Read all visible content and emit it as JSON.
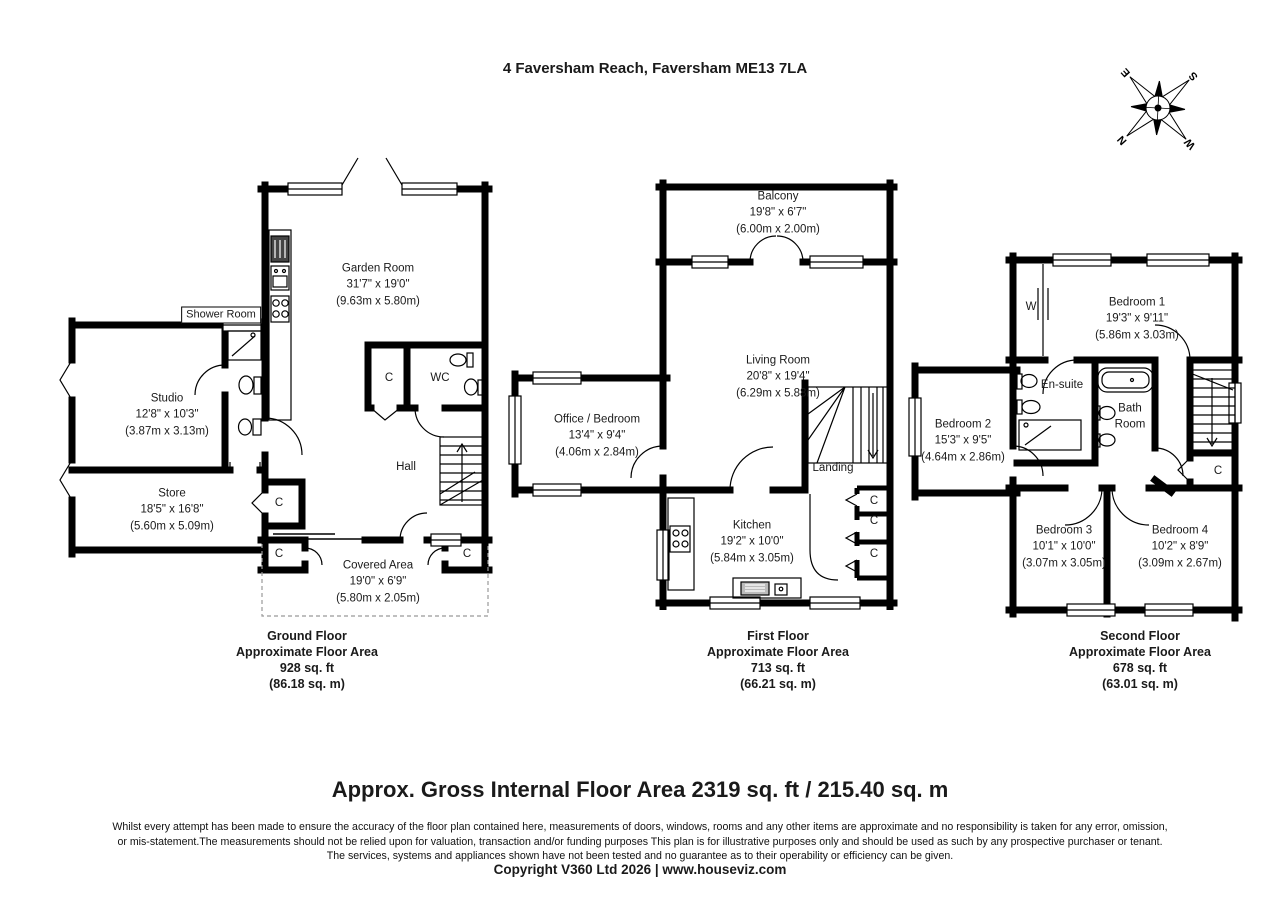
{
  "header": {
    "title": "4 Faversham Reach, Faversham ME13 7LA"
  },
  "compass": {
    "n": "N",
    "e": "E",
    "s": "S",
    "w": "W"
  },
  "labels": {
    "closet": "C",
    "wardrobe": "W"
  },
  "floors": {
    "ground": {
      "caption": {
        "name": "Ground Floor",
        "area_label": "Approximate Floor Area",
        "area_ft": "928 sq. ft",
        "area_m": "(86.18 sq. m)"
      },
      "rooms": {
        "garden_room": {
          "name": "Garden Room",
          "ft": "31'7\" x 19'0\"",
          "m": "(9.63m x 5.80m)"
        },
        "shower_room": {
          "name": "Shower Room"
        },
        "studio": {
          "name": "Studio",
          "ft": "12'8\" x 10'3\"",
          "m": "(3.87m x 3.13m)"
        },
        "store": {
          "name": "Store",
          "ft": "18'5\" x 16'8\"",
          "m": "(5.60m x 5.09m)"
        },
        "hall": {
          "name": "Hall"
        },
        "wc": {
          "name": "WC"
        },
        "covered_area": {
          "name": "Covered Area",
          "ft": "19'0\" x 6'9\"",
          "m": "(5.80m x 2.05m)"
        }
      }
    },
    "first": {
      "caption": {
        "name": "First Floor",
        "area_label": "Approximate Floor Area",
        "area_ft": "713 sq. ft",
        "area_m": "(66.21 sq. m)"
      },
      "rooms": {
        "balcony": {
          "name": "Balcony",
          "ft": "19'8\" x 6'7\"",
          "m": "(6.00m x 2.00m)"
        },
        "living_room": {
          "name": "Living Room",
          "ft": "20'8\" x 19'4\"",
          "m": "(6.29m x 5.88m)"
        },
        "office_bedroom": {
          "name": "Office / Bedroom",
          "ft": "13'4\" x 9'4\"",
          "m": "(4.06m x 2.84m)"
        },
        "landing": {
          "name": "Landing"
        },
        "kitchen": {
          "name": "Kitchen",
          "ft": "19'2\" x 10'0\"",
          "m": "(5.84m x 3.05m)"
        }
      }
    },
    "second": {
      "caption": {
        "name": "Second Floor",
        "area_label": "Approximate Floor Area",
        "area_ft": "678 sq. ft",
        "area_m": "(63.01 sq. m)"
      },
      "rooms": {
        "bedroom1": {
          "name": "Bedroom 1",
          "ft": "19'3\" x 9'11\"",
          "m": "(5.86m x 3.03m)"
        },
        "bedroom2": {
          "name": "Bedroom 2",
          "ft": "15'3\" x 9'5\"",
          "m": "(4.64m x 2.86m)"
        },
        "bedroom3": {
          "name": "Bedroom 3",
          "ft": "10'1\" x 10'0\"",
          "m": "(3.07m x 3.05m)"
        },
        "bedroom4": {
          "name": "Bedroom 4",
          "ft": "10'2\" x 8'9\"",
          "m": "(3.09m x 2.67m)"
        },
        "ensuite": {
          "name": "En-suite"
        },
        "bathroom": {
          "name": "Bath Room"
        }
      }
    }
  },
  "footer": {
    "summary": "Approx. Gross Internal Floor Area 2319 sq. ft / 215.40 sq. m",
    "disclaimer1": "Whilst every attempt has been made to ensure the accuracy of the floor plan contained here, measurements of doors, windows, rooms and any other items are approximate and no responsibility is taken for any error, omission,",
    "disclaimer2": "or mis-statement.The measurements should not be relied upon for valuation, transaction and/or funding purposes This plan is for illustrative purposes only and should be used as such by any prospective purchaser or tenant.",
    "disclaimer3": "The services, systems and appliances shown have not been tested and no guarantee as to their operability or efficiency can be given.",
    "copyright": "Copyright V360 Ltd 2026 | www.houseviz.com"
  }
}
